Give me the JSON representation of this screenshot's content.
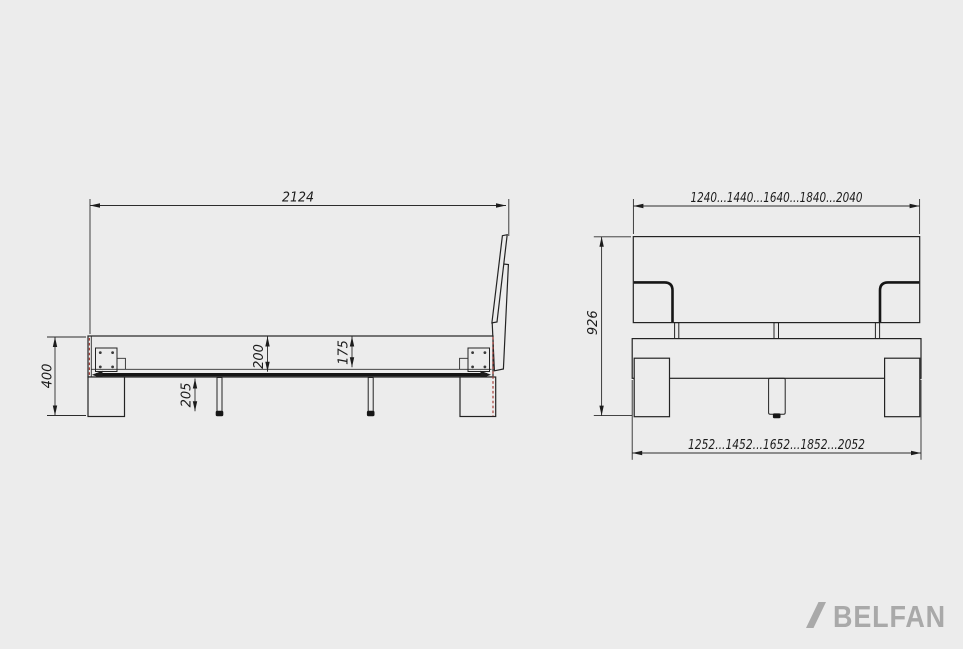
{
  "canvas": {
    "background": "#ececec",
    "line_color": "#232323",
    "highlight_red": "#a8403a",
    "logo_gray": "#a9a9a9"
  },
  "side_view": {
    "dims": {
      "length": "2124",
      "height_total": "400",
      "slat_leg_height": "205",
      "rail_height": "200",
      "rail_inner_depth": "175"
    }
  },
  "front_view": {
    "dims": {
      "top_widths": "1240...1440...1640...1840...2040",
      "height_total": "926",
      "bottom_widths": "1252...1452...1652...1852...2052"
    }
  },
  "logo": {
    "brand": "BELFAN"
  }
}
